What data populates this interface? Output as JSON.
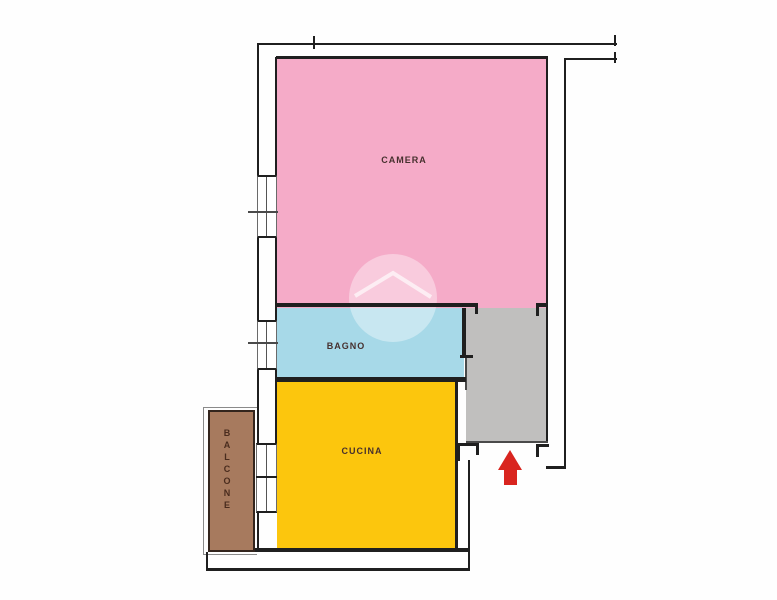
{
  "plan": {
    "type": "apartment-floor-plan",
    "rooms": {
      "camera": {
        "label": "CAMERA",
        "color": "#f5abc8"
      },
      "bagno": {
        "label": "BAGNO",
        "color": "#a7d9e8"
      },
      "cucina": {
        "label": "CUCINA",
        "color": "#fcc60d"
      },
      "balcone": {
        "label": "BALCONE",
        "color": "#a77a5e"
      },
      "ingresso": {
        "color": "#c0bfbe"
      }
    },
    "colors": {
      "wall": "#1f1f1f",
      "entrance_arrow": "#d9251f",
      "watermark": "rgba(255,255,255,0.4)",
      "background": "#fefefe"
    },
    "icons": {
      "entrance_arrow": "up-arrow-icon",
      "watermark": "house-roof-watermark-icon"
    }
  }
}
